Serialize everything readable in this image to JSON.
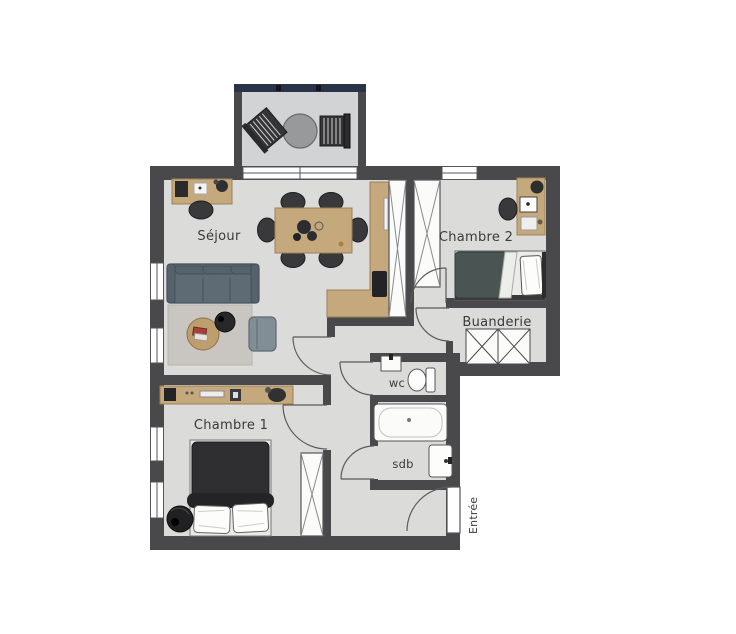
{
  "floor_plan": {
    "room_labels": {
      "sejour": "Séjour",
      "chambre2": "Chambre 2",
      "chambre1": "Chambre 1",
      "buanderie": "Buanderie",
      "wc": "wc",
      "sdb": "sdb",
      "entree": "Entrée"
    },
    "palette": {
      "wall": "#49494b",
      "floor": "#dbdbda",
      "balcony_floor": "#d2d3d5",
      "railing": "#2b3349",
      "wood": "#c5a87c",
      "sofa": "#5f6b74",
      "rug": "#c9c6c1",
      "coffee_table": "#bf9e6e",
      "armchair": "#828e96",
      "dark_furniture": "#39393b",
      "bed1_duvet": "#2f2f31",
      "bed2_duvet": "#4a5553",
      "fixture_white": "#fbfbfa",
      "label_text": "#3a3a3a"
    }
  }
}
